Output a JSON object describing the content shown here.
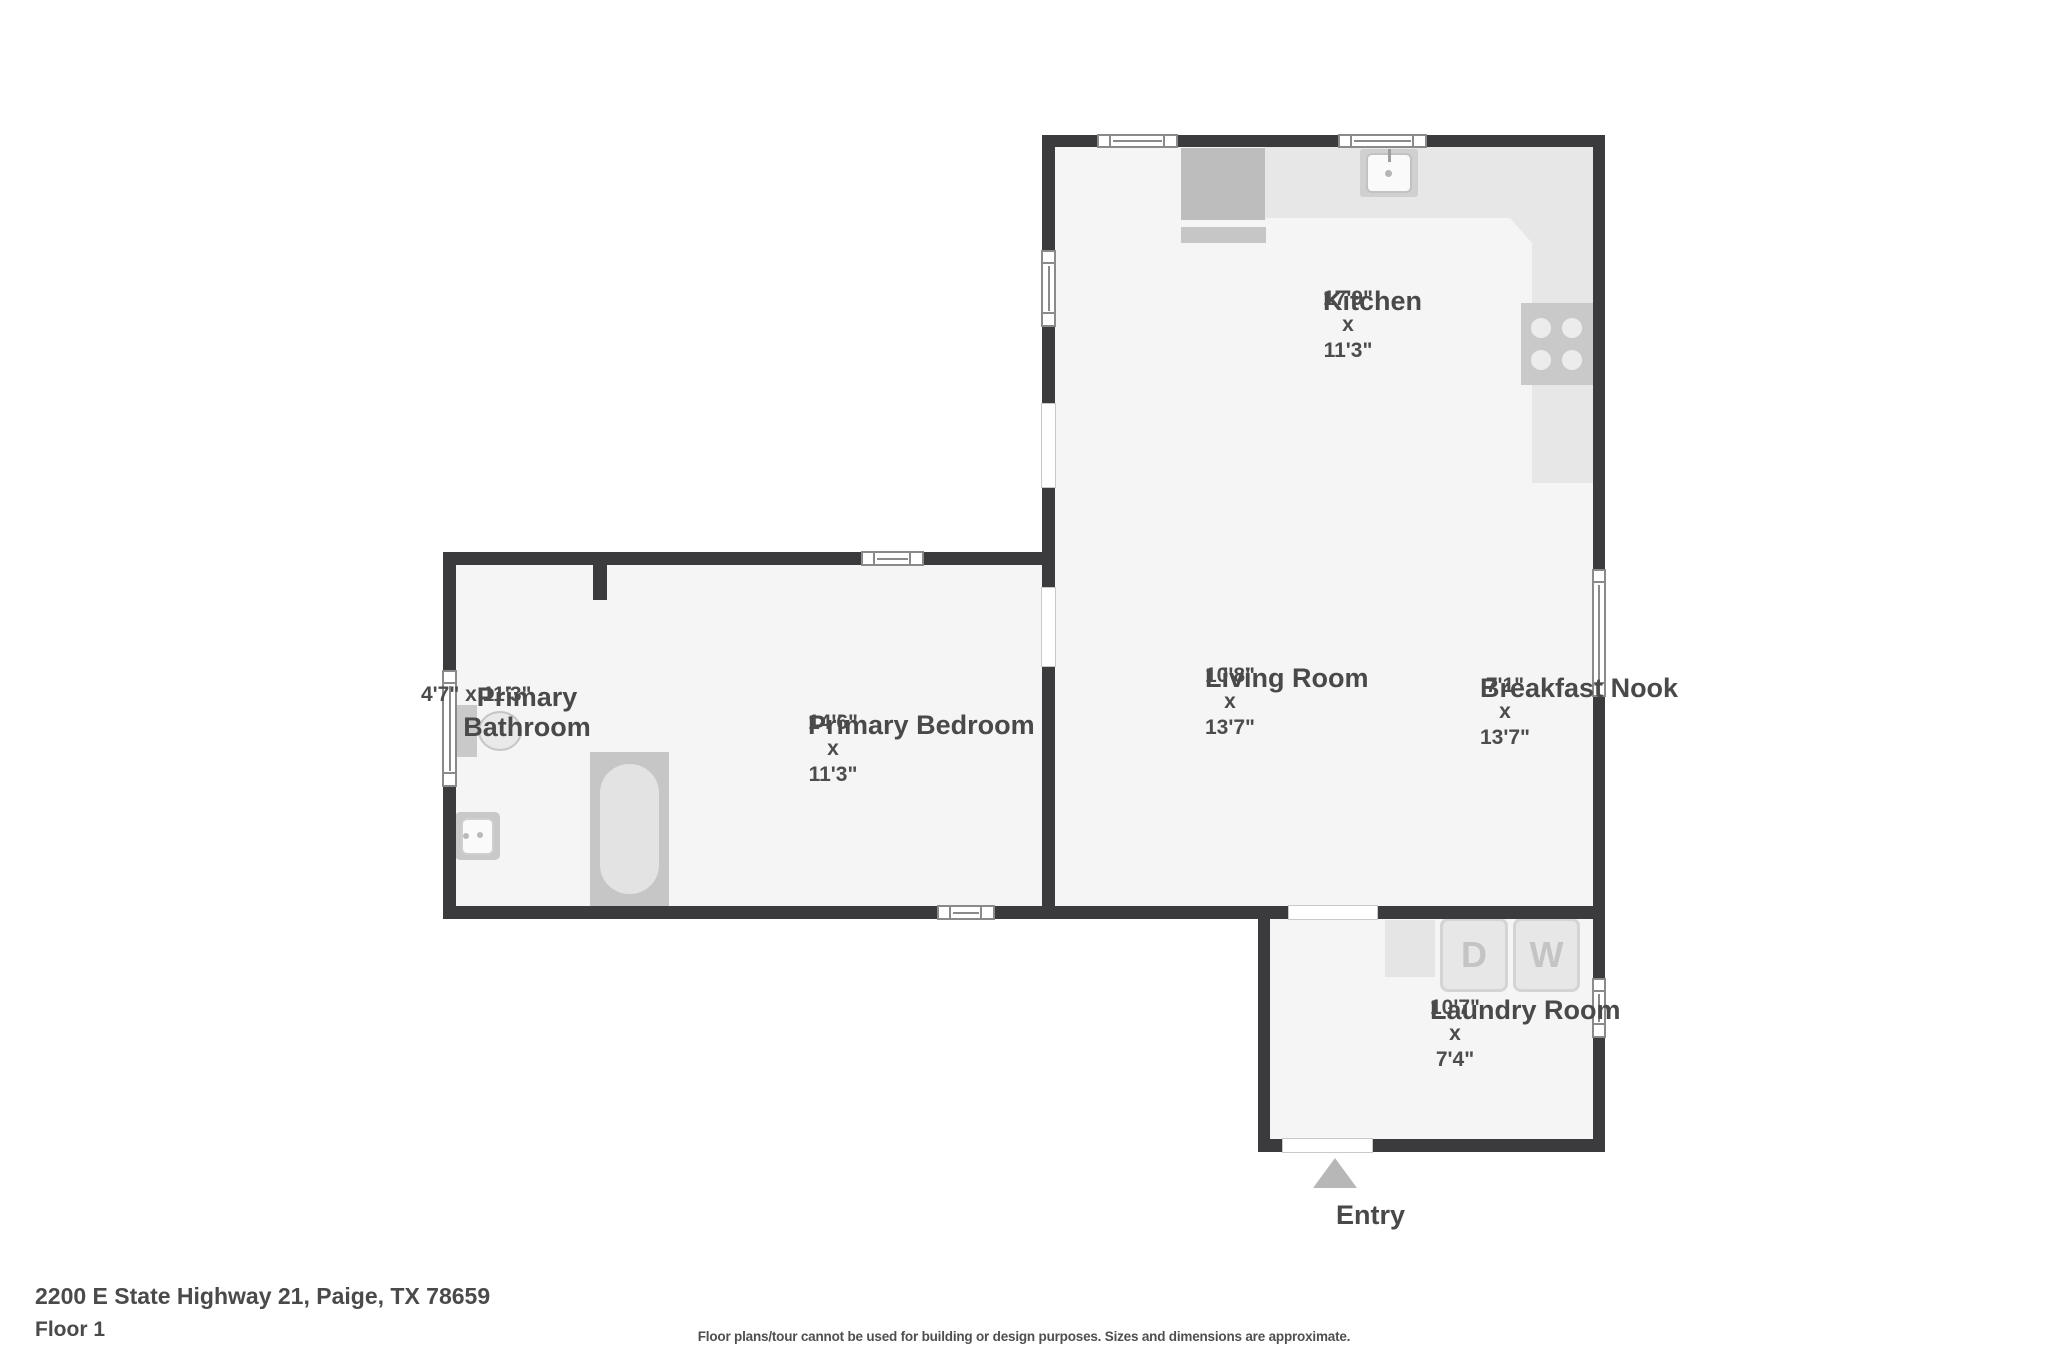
{
  "floorplan": {
    "rooms": [
      {
        "name": "Kitchen",
        "dims": "17'9\" x 11'3\""
      },
      {
        "name": "Primary Bathroom",
        "dims": "4'7\" x 11'3\""
      },
      {
        "name": "Primary Bedroom",
        "dims": "14'6\" x 11'3\""
      },
      {
        "name": "Living Room",
        "dims": "10'8\" x 13'7\""
      },
      {
        "name": "Breakfast Nook",
        "dims": "7'1\" x 13'7\""
      },
      {
        "name": "Laundry Room",
        "dims": "10'7\" x 7'4\""
      }
    ],
    "entry_label": "Entry",
    "entry_arrow_icon": "triangle-up",
    "appliances": {
      "dryer_letter": "D",
      "washer_letter": "W"
    }
  },
  "footer": {
    "address": "2200 E State Highway 21, Paige, TX 78659",
    "floor_label": "Floor 1",
    "disclaimer": "Floor plans/tour cannot be used for building or design purposes. Sizes and dimensions are approximate."
  },
  "colors": {
    "wall": "#3b3b3d",
    "floor": "#f5f5f5",
    "counter": "#e7e7e7",
    "fixture": "#c6c6c6",
    "text": "#494949"
  }
}
